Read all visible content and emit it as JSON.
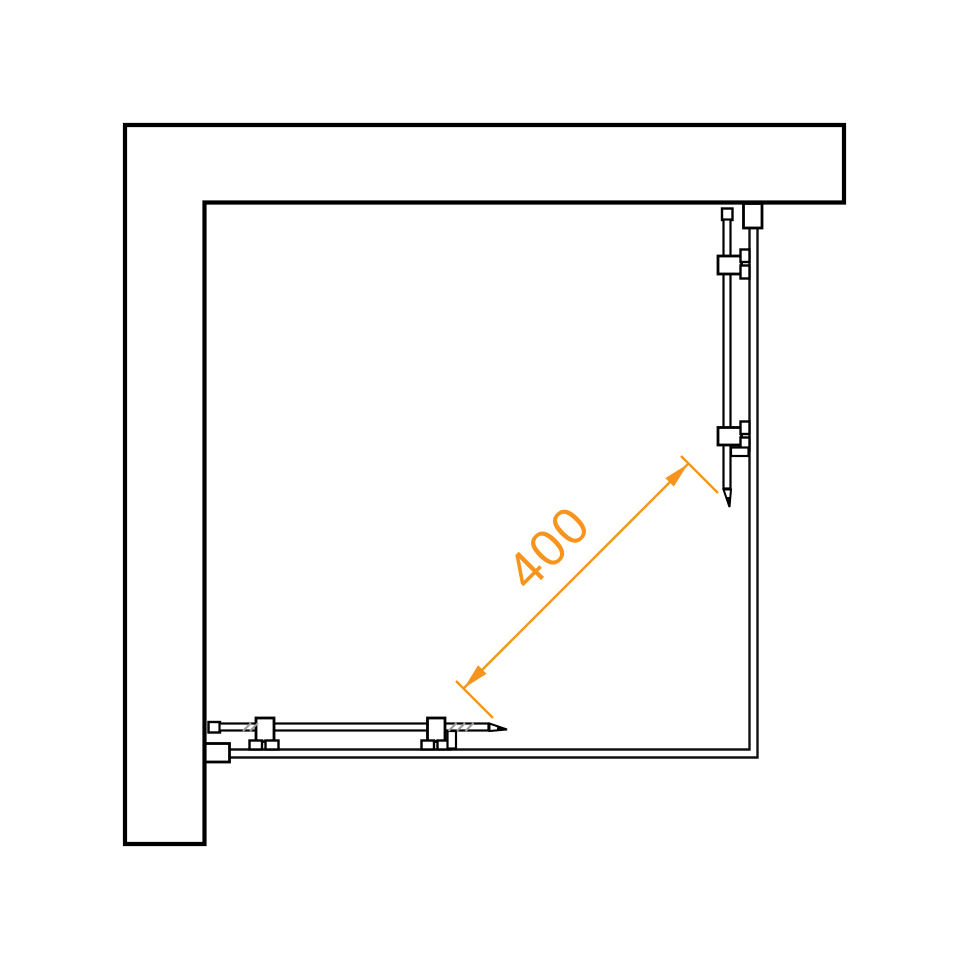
{
  "diagram": {
    "dimension": {
      "label": "400"
    },
    "colors": {
      "ink": "#000000",
      "line": "#111111",
      "tick": "#999999",
      "accent": "#f7941e",
      "background": "#ffffff"
    }
  }
}
